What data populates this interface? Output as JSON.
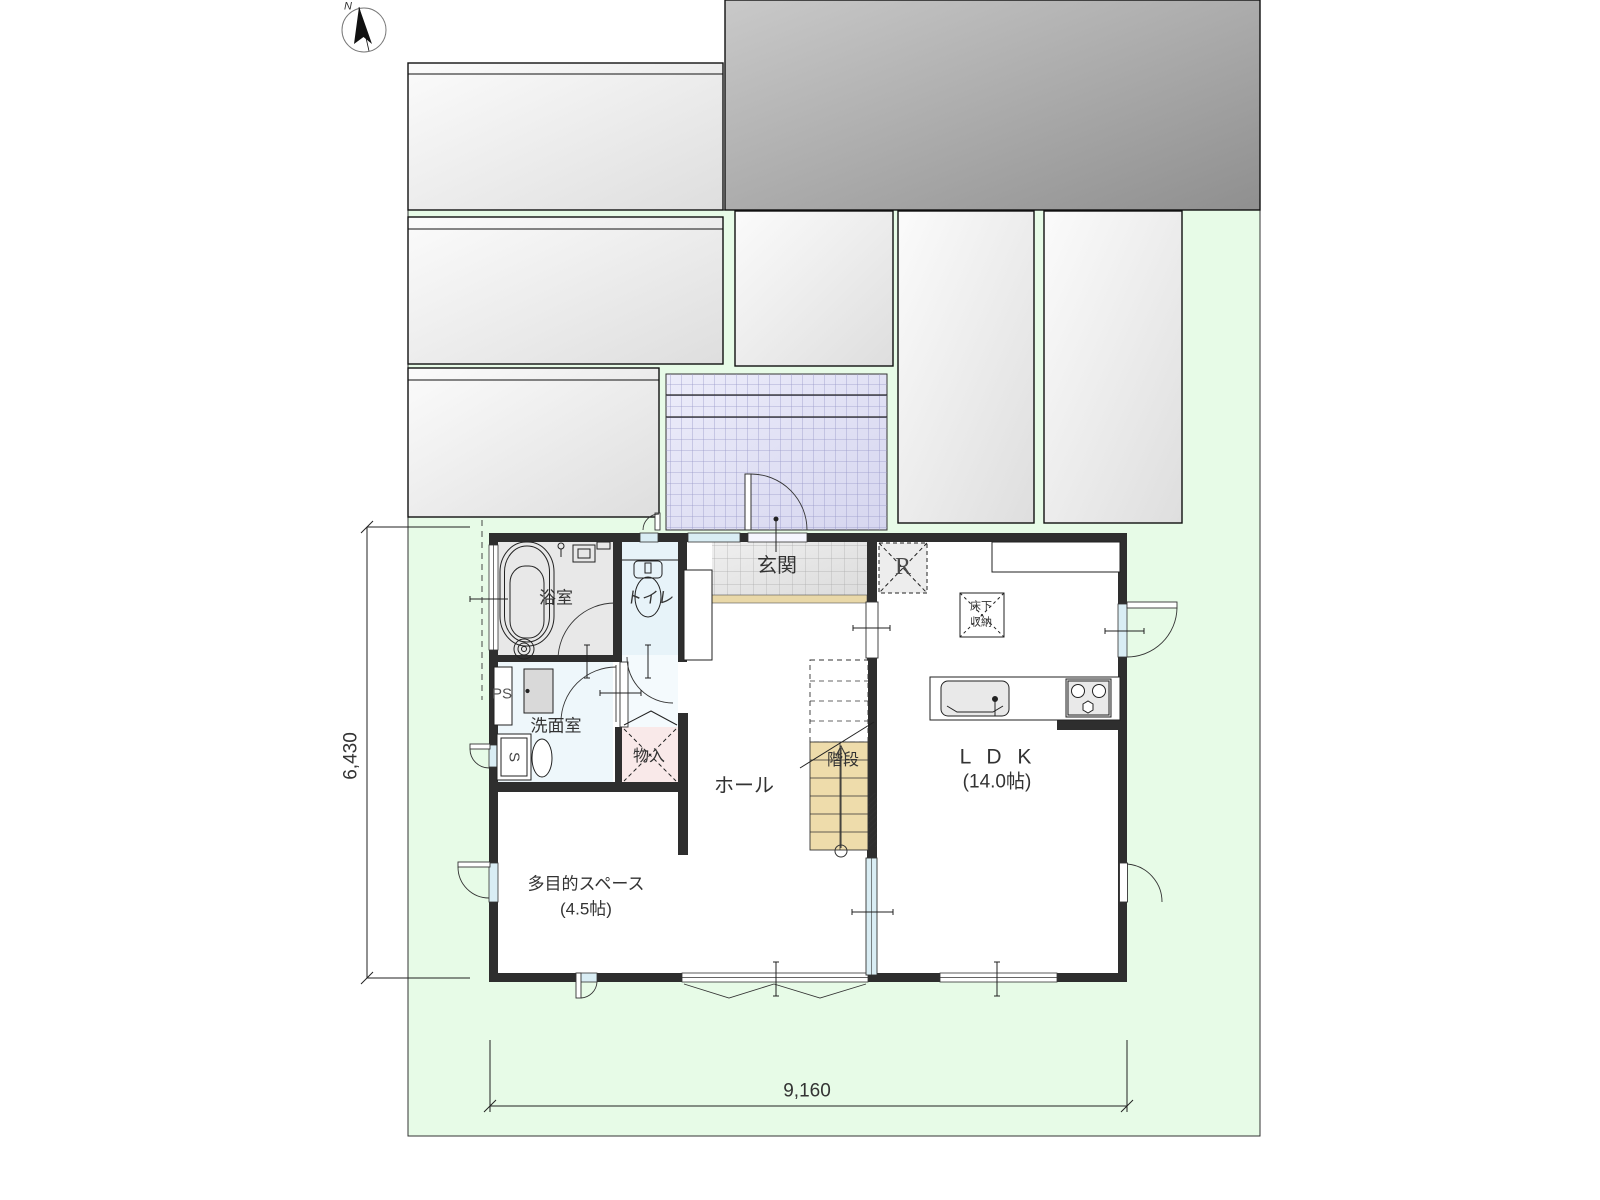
{
  "plan": {
    "north_label": "N",
    "rooms": {
      "entrance": "玄関",
      "bathroom": "浴室",
      "toilet": "トイレ",
      "washroom": "洗面室",
      "pipe_space": "PS",
      "sink_mark": "S",
      "closet": "物入",
      "hall": "ホール",
      "stairs": "階段",
      "refrigerator_mark": "R",
      "underfloor_storage_line1": "床下",
      "underfloor_storage_line2": "収納",
      "ldk": "L D K",
      "ldk_size": "(14.0帖)",
      "multipurpose": "多目的スペース",
      "multipurpose_size": "(4.5帖)"
    },
    "dimensions": {
      "width_mm": "9,160",
      "height_mm": "6,430"
    },
    "colors": {
      "lot_green": "#e7fbe7",
      "porch_tile": "#dcdcf2",
      "porch_grid": "#9898c8",
      "entrance_tile": "#e4e4e4",
      "entrance_tile_grid": "#ababab",
      "step_beige": "#e9d8a8",
      "stairs_beige": "#eedcab",
      "bathroom_gray": "#e8e8e8",
      "water_area_blue": "#e7f3f9",
      "closet_pink": "#f9e9e9",
      "window_blue": "#d9edf4",
      "wall_black": "#2e2e2e",
      "neighbor_block_light": "#dedede",
      "neighbor_block_dark": "#8f8f8f",
      "landing_lavender": "#e3e3f5",
      "text_color": "#333333"
    }
  }
}
